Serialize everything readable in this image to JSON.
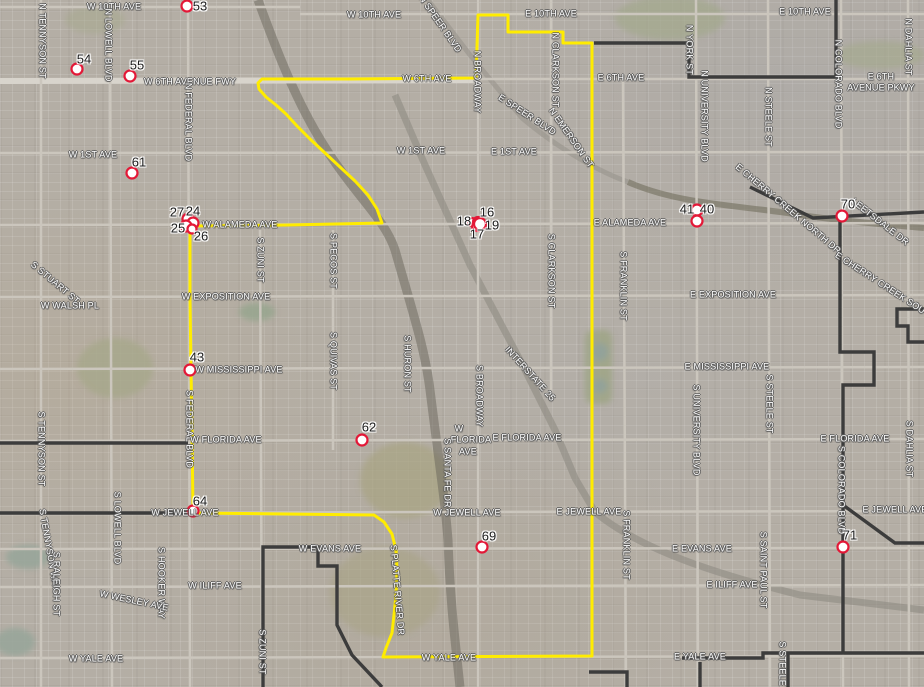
{
  "map": {
    "colors": {
      "route": "#ffec00",
      "boundary": "#3c3c3c",
      "marker_fill": "#ffffff",
      "marker_stroke": "#e31837",
      "street_label_text": "#ffffff",
      "marker_label_text": "#1c1c1c"
    },
    "street_labels": [
      {
        "text": "W 10TH AVE",
        "x": 114,
        "y": 7
      },
      {
        "text": "W 10TH AVE",
        "x": 374,
        "y": 15
      },
      {
        "text": "E 10TH AVE",
        "x": 551,
        "y": 14
      },
      {
        "text": "E 10TH AVE",
        "x": 805,
        "y": 12
      },
      {
        "text": "N TENNYSON ST",
        "x": 42,
        "y": 41,
        "rot": 90
      },
      {
        "text": "N LOWELL BLVD",
        "x": 108,
        "y": 45,
        "rot": 90
      },
      {
        "text": "N SPEER BLVD",
        "x": 440,
        "y": 24,
        "rot": 55
      },
      {
        "text": "W 6TH AVENUE FWY",
        "x": 190,
        "y": 82
      },
      {
        "text": "W 6TH AVE",
        "x": 427,
        "y": 79
      },
      {
        "text": "E 6TH AVE",
        "x": 621,
        "y": 78
      },
      {
        "text": "E 6TH",
        "x": 881,
        "y": 77
      },
      {
        "text": "AVENUE PKWY",
        "x": 881,
        "y": 88
      },
      {
        "text": "N FEDERAL BLVD",
        "x": 188,
        "y": 122,
        "rot": 90
      },
      {
        "text": "N BROADWAY",
        "x": 477,
        "y": 82,
        "rot": 90
      },
      {
        "text": "N CLARKSON ST",
        "x": 555,
        "y": 70,
        "rot": 90
      },
      {
        "text": "N YORK ST",
        "x": 689,
        "y": 50,
        "rot": 90
      },
      {
        "text": "N UNIVERSITY BLVD",
        "x": 704,
        "y": 116,
        "rot": 90
      },
      {
        "text": "N STEELE ST",
        "x": 768,
        "y": 117,
        "rot": 90
      },
      {
        "text": "N COLORADO BLVD",
        "x": 838,
        "y": 84,
        "rot": 90
      },
      {
        "text": "N DAHLIA ST",
        "x": 908,
        "y": 47,
        "rot": 90
      },
      {
        "text": "W 1ST AVE",
        "x": 93,
        "y": 155
      },
      {
        "text": "W 1ST AVE",
        "x": 421,
        "y": 151
      },
      {
        "text": "E 1ST AVE",
        "x": 514,
        "y": 152
      },
      {
        "text": "E SPEER BLVD",
        "x": 527,
        "y": 115,
        "rot": 33
      },
      {
        "text": "N EMERSON ST",
        "x": 571,
        "y": 138,
        "rot": 55
      },
      {
        "text": "W ALAMEDA AVE",
        "x": 240,
        "y": 225
      },
      {
        "text": "E ALAMEDA AVE",
        "x": 630,
        "y": 223
      },
      {
        "text": "E CHERRY CREEK NORTH DR",
        "x": 788,
        "y": 209,
        "rot": 40
      },
      {
        "text": "LEETSDALE DR",
        "x": 880,
        "y": 222,
        "rot": 38
      },
      {
        "text": "E CHERRY CREEK SOUTH DR",
        "x": 892,
        "y": 291,
        "rot": 33
      },
      {
        "text": "S ZUNI ST",
        "x": 260,
        "y": 260,
        "rot": 90
      },
      {
        "text": "S PECOS ST",
        "x": 333,
        "y": 261,
        "rot": 90
      },
      {
        "text": "S CLARKSON ST",
        "x": 551,
        "y": 271,
        "rot": 90
      },
      {
        "text": "S FRANKLIN ST",
        "x": 623,
        "y": 286,
        "rot": 90
      },
      {
        "text": "W EXPOSITION AVE",
        "x": 226,
        "y": 297
      },
      {
        "text": "E EXPOSITION AVE",
        "x": 733,
        "y": 295
      },
      {
        "text": "S STUART ST",
        "x": 55,
        "y": 283,
        "rot": 40
      },
      {
        "text": "W WALSH PL",
        "x": 70,
        "y": 306
      },
      {
        "text": "W MISSISSIPPI AVE",
        "x": 239,
        "y": 370
      },
      {
        "text": "E MISSISSIPPI AVE",
        "x": 727,
        "y": 367
      },
      {
        "text": "S QUIVAS ST",
        "x": 333,
        "y": 361,
        "rot": 90
      },
      {
        "text": "S HURON ST",
        "x": 407,
        "y": 364,
        "rot": 90
      },
      {
        "text": "S BROADWAY",
        "x": 479,
        "y": 396,
        "rot": 90
      },
      {
        "text": "INTERSTATE 25",
        "x": 530,
        "y": 374,
        "rot": 48
      },
      {
        "text": "S FEDERAL BLVD",
        "x": 189,
        "y": 429,
        "rot": 90
      },
      {
        "text": "S TENNYSON ST",
        "x": 41,
        "y": 449,
        "rot": 90
      },
      {
        "text": "W FLORIDA AVE",
        "x": 226,
        "y": 440
      },
      {
        "text": "W",
        "x": 459,
        "y": 429
      },
      {
        "text": "FLORIDA",
        "x": 471,
        "y": 440
      },
      {
        "text": "AVE",
        "x": 468,
        "y": 452
      },
      {
        "text": "E FLORIDA AVE",
        "x": 527,
        "y": 438
      },
      {
        "text": "E FLORIDA AVE",
        "x": 855,
        "y": 439
      },
      {
        "text": "S STEELE ST",
        "x": 769,
        "y": 404,
        "rot": 90
      },
      {
        "text": "S UNIVERSITY BLVD",
        "x": 696,
        "y": 430,
        "rot": 90
      },
      {
        "text": "S DAHLIA ST",
        "x": 909,
        "y": 449,
        "rot": 90
      },
      {
        "text": "S COLORADO BLVD",
        "x": 841,
        "y": 490,
        "rot": 90
      },
      {
        "text": "S SANTA FE DR",
        "x": 447,
        "y": 473,
        "rot": 90
      },
      {
        "text": "W JEWELL AVE",
        "x": 185,
        "y": 513
      },
      {
        "text": "W JEWELL AVE",
        "x": 467,
        "y": 513
      },
      {
        "text": "E JEWELL AVE",
        "x": 589,
        "y": 512
      },
      {
        "text": "E JEWELL AVE",
        "x": 895,
        "y": 510
      },
      {
        "text": "S LOWELL BLVD",
        "x": 117,
        "y": 528,
        "rot": 90
      },
      {
        "text": "W EVANS AVE",
        "x": 330,
        "y": 549
      },
      {
        "text": "E EVANS AVE",
        "x": 702,
        "y": 549
      },
      {
        "text": "S FRANKLIN ST",
        "x": 626,
        "y": 545,
        "rot": 90
      },
      {
        "text": "S SAINT PAUL ST",
        "x": 763,
        "y": 570,
        "rot": 90
      },
      {
        "text": "S PLATTE RIVER DR",
        "x": 397,
        "y": 590,
        "rot": 85
      },
      {
        "text": "S TENNYSON WAY",
        "x": 49,
        "y": 550,
        "rot": 80
      },
      {
        "text": "S RALEIGH ST",
        "x": 56,
        "y": 584,
        "rot": 90
      },
      {
        "text": "S HOOKER WAY",
        "x": 161,
        "y": 583,
        "rot": 90
      },
      {
        "text": "W WESLEY AVE",
        "x": 134,
        "y": 601,
        "rot": 12
      },
      {
        "text": "W ILIFF AVE",
        "x": 215,
        "y": 586
      },
      {
        "text": "E ILIFF AVE",
        "x": 732,
        "y": 585
      },
      {
        "text": "S ZUNI ST",
        "x": 262,
        "y": 652,
        "rot": 90
      },
      {
        "text": "W YALE AVE",
        "x": 96,
        "y": 659
      },
      {
        "text": "W YALE AVE",
        "x": 449,
        "y": 658
      },
      {
        "text": "E YALE AVE",
        "x": 700,
        "y": 657
      },
      {
        "text": "S STEELE ST",
        "x": 782,
        "y": 671,
        "rot": 90
      }
    ],
    "markers": [
      {
        "label": "53",
        "cx": 187,
        "cy": 6,
        "lx": 200,
        "ly": 6
      },
      {
        "label": "54",
        "cx": 77,
        "cy": 69,
        "lx": 84,
        "ly": 59
      },
      {
        "label": "55",
        "cx": 130,
        "cy": 76,
        "lx": 137,
        "ly": 65
      },
      {
        "label": "61",
        "cx": 132,
        "cy": 173,
        "lx": 139,
        "ly": 162
      },
      {
        "label": "27",
        "cx": 188,
        "cy": 219,
        "lx": 177,
        "ly": 212
      },
      {
        "label": "24",
        "cx": 193,
        "cy": 223,
        "lx": 193,
        "ly": 211
      },
      {
        "label": "25",
        "cx": 186,
        "cy": 226,
        "lx": 178,
        "ly": 228
      },
      {
        "label": "26",
        "cx": 192,
        "cy": 229,
        "lx": 201,
        "ly": 236,
        "r": 4.5
      },
      {
        "label": "18",
        "cx": 472,
        "cy": 222,
        "lx": 464,
        "ly": 221,
        "r": 4
      },
      {
        "label": "16",
        "cx": 478,
        "cy": 222,
        "lx": 487,
        "ly": 212,
        "r": 5
      },
      {
        "label": "17",
        "cx": 477,
        "cy": 226,
        "lx": 477,
        "ly": 234,
        "r": 5
      },
      {
        "label": "19",
        "cx": 480,
        "cy": 224,
        "lx": 492,
        "ly": 225,
        "r": 6
      },
      {
        "label": "41",
        "cx": 697,
        "cy": 210,
        "lx": 687,
        "ly": 209
      },
      {
        "label": "40",
        "cx": 697,
        "cy": 221,
        "lx": 707,
        "ly": 209
      },
      {
        "label": "43",
        "cx": 190,
        "cy": 370,
        "lx": 197,
        "ly": 357
      },
      {
        "label": "62",
        "cx": 362,
        "cy": 440,
        "lx": 369,
        "ly": 427
      },
      {
        "label": "64",
        "cx": 193,
        "cy": 511,
        "lx": 200,
        "ly": 501
      },
      {
        "label": "69",
        "cx": 482,
        "cy": 547,
        "lx": 489,
        "ly": 536
      },
      {
        "label": "70",
        "cx": 842,
        "cy": 216,
        "lx": 848,
        "ly": 204
      },
      {
        "label": "71",
        "cx": 843,
        "cy": 547,
        "lx": 850,
        "ly": 535
      }
    ],
    "route": {
      "closed": true,
      "points": [
        [
          478,
          15
        ],
        [
          508,
          15
        ],
        [
          508,
          32
        ],
        [
          563,
          32
        ],
        [
          563,
          43
        ],
        [
          592,
          43
        ],
        [
          592,
          656
        ],
        [
          383,
          657
        ],
        [
          386,
          648
        ],
        [
          392,
          633
        ],
        [
          394,
          615
        ],
        [
          396,
          595
        ],
        [
          397,
          570
        ],
        [
          396,
          550
        ],
        [
          392,
          534
        ],
        [
          384,
          522
        ],
        [
          374,
          515
        ],
        [
          193,
          513
        ],
        [
          192,
          430
        ],
        [
          191,
          370
        ],
        [
          190,
          297
        ],
        [
          190,
          226
        ],
        [
          288,
          225
        ],
        [
          382,
          223
        ],
        [
          377,
          209
        ],
        [
          368,
          195
        ],
        [
          355,
          181
        ],
        [
          340,
          167
        ],
        [
          325,
          153
        ],
        [
          310,
          139
        ],
        [
          297,
          126
        ],
        [
          286,
          114
        ],
        [
          276,
          105
        ],
        [
          266,
          97
        ],
        [
          259,
          89
        ],
        [
          258,
          83
        ],
        [
          262,
          79
        ],
        [
          350,
          79
        ],
        [
          476,
          78
        ]
      ]
    },
    "boundaries": [
      {
        "points": [
          [
            594,
            43
          ],
          [
            689,
            43
          ],
          [
            689,
            77
          ],
          [
            836,
            77
          ],
          [
            836,
            0
          ]
        ]
      },
      {
        "points": [
          [
            750,
            187
          ],
          [
            813,
            218
          ],
          [
            924,
            212
          ]
        ]
      },
      {
        "points": [
          [
            840,
            218
          ],
          [
            840,
            352
          ],
          [
            874,
            352
          ],
          [
            874,
            385
          ],
          [
            843,
            385
          ],
          [
            843,
            653
          ]
        ]
      },
      {
        "points": [
          [
            924,
            309
          ],
          [
            897,
            309
          ],
          [
            897,
            326
          ],
          [
            908,
            326
          ],
          [
            908,
            342
          ],
          [
            924,
            342
          ]
        ]
      },
      {
        "points": [
          [
            0,
            513
          ],
          [
            190,
            513
          ]
        ]
      },
      {
        "points": [
          [
            0,
            443
          ],
          [
            188,
            443
          ]
        ]
      },
      {
        "points": [
          [
            263,
            687
          ],
          [
            263,
            547
          ],
          [
            318,
            547
          ],
          [
            318,
            566
          ],
          [
            337,
            566
          ],
          [
            337,
            625
          ],
          [
            352,
            655
          ],
          [
            382,
            687
          ]
        ]
      },
      {
        "points": [
          [
            589,
            672
          ],
          [
            627,
            672
          ],
          [
            627,
            687
          ]
        ]
      },
      {
        "points": [
          [
            700,
            662
          ],
          [
            700,
            687
          ]
        ]
      },
      {
        "points": [
          [
            682,
            658
          ],
          [
            763,
            658
          ],
          [
            763,
            653
          ],
          [
            924,
            653
          ]
        ]
      },
      {
        "points": [
          [
            788,
            653
          ],
          [
            788,
            687
          ]
        ]
      },
      {
        "points": [
          [
            843,
            505
          ],
          [
            895,
            543
          ],
          [
            924,
            543
          ]
        ]
      }
    ]
  }
}
